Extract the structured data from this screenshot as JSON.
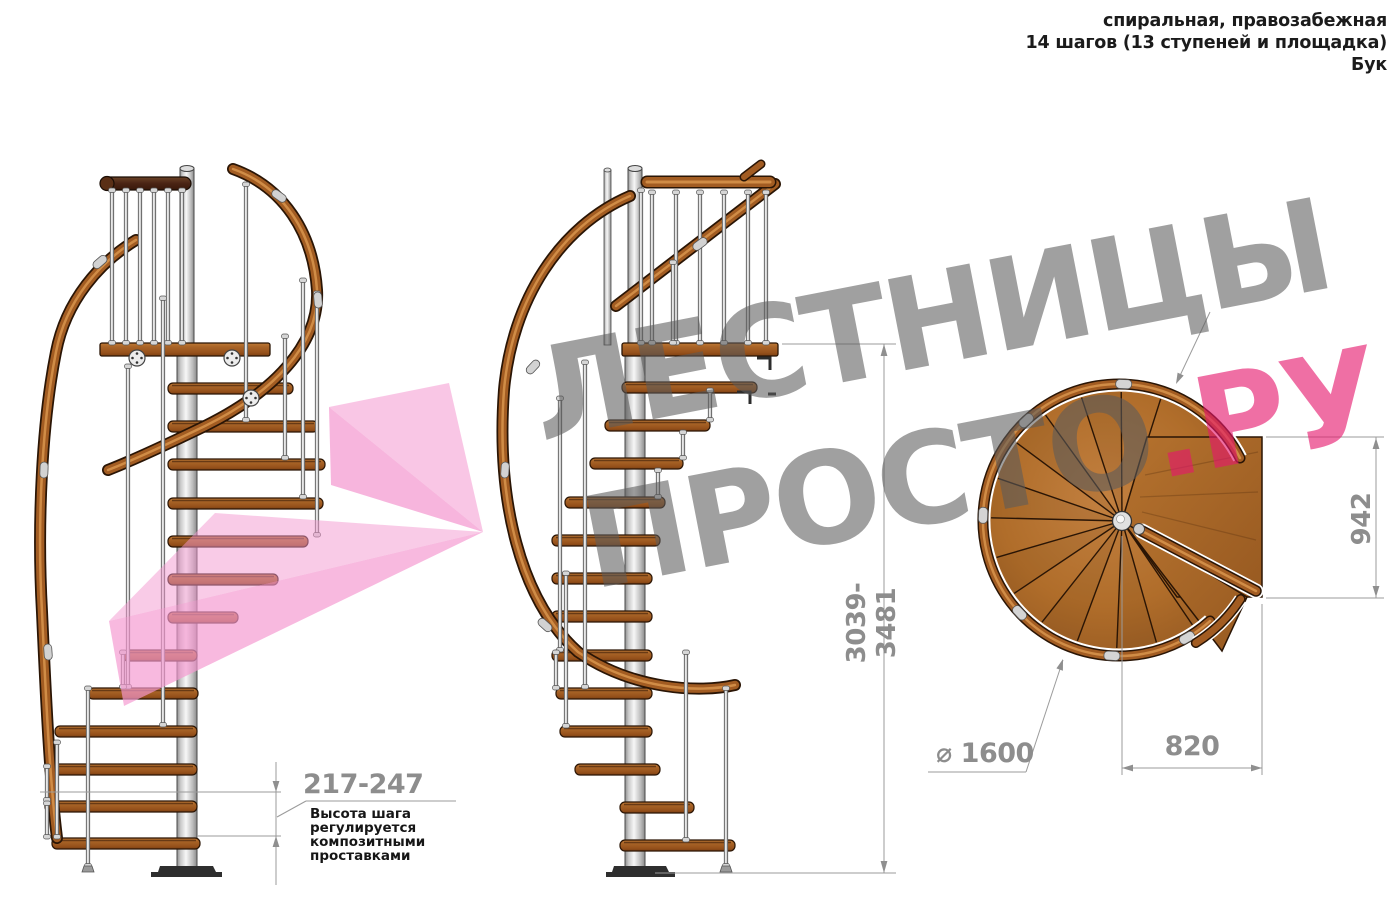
{
  "header": {
    "line1": "спиральная, правозабежная",
    "line2": "14 шагов (13 ступеней и площадка)",
    "line3": "Бук"
  },
  "watermark": {
    "word1": "ЛЕСТНИЦЫ",
    "word2": "ПРОСТО",
    "word2_suffix": ".РУ"
  },
  "dimensions": {
    "step_height": {
      "value": "217-247",
      "note": {
        "line1": "Высота шага",
        "line2": "регулируется",
        "line3": "композитными",
        "line4": "проставками"
      }
    },
    "total_height": {
      "value": "3039-3481"
    },
    "landing_length": {
      "value": "942"
    },
    "landing_width": {
      "value": "820"
    },
    "diameter": {
      "value": "⌀ 1600"
    }
  },
  "colors": {
    "watermark_gray": "#9c9c9c",
    "watermark_pink": "#e8176c",
    "wood": "#a86226",
    "handrail": "#a25c22",
    "metal": "#cfcfcf",
    "dim_gray": "#8d8d8d"
  }
}
